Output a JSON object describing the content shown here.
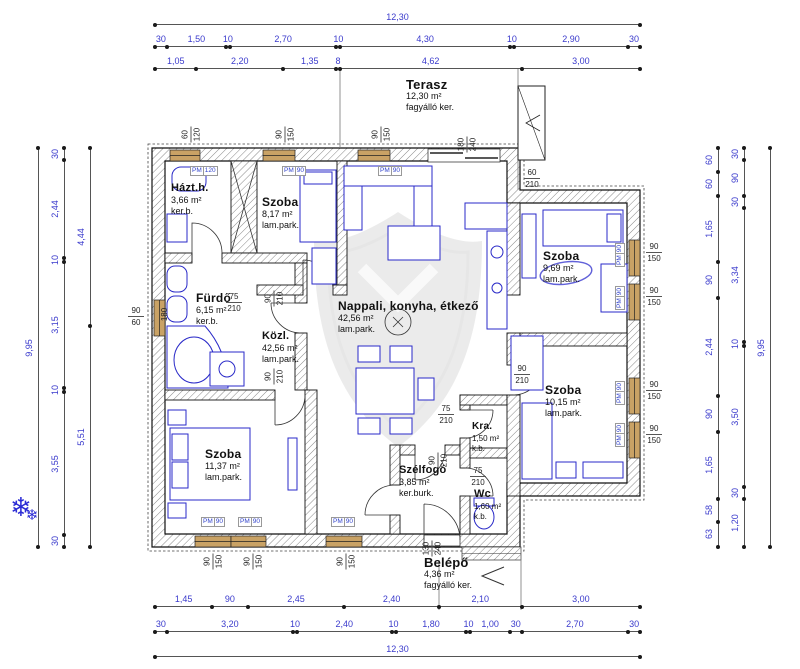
{
  "colors": {
    "dimension": "#3a3acc",
    "wall_outline": "#1a1a1a",
    "furniture": "#2a2ac8",
    "window_frame": "#c9a265",
    "watermark": "#d9d9d9"
  },
  "dims": {
    "top": {
      "total": [
        "12,30"
      ],
      "chain": [
        "30",
        "1,50",
        "10",
        "2,70",
        "10",
        "4,30",
        "10",
        "2,90",
        "30"
      ],
      "chain2": [
        "1,05",
        "2,20",
        "1,35",
        "8",
        "4,62",
        "3,00"
      ]
    },
    "bottom": {
      "chain1": [
        "1,45",
        "90",
        "2,45",
        "2,40",
        "2,10",
        "3,00"
      ],
      "chain2": [
        "30",
        "3,20",
        "10",
        "2,40",
        "10",
        "1,80",
        "10",
        "1,00",
        "30",
        "2,70",
        "30"
      ],
      "total": [
        "12,30"
      ]
    },
    "left": {
      "outer": [
        "9,95"
      ],
      "middle": [
        "30",
        "2,44",
        "10",
        "3,15",
        "10",
        "3,55",
        "30"
      ],
      "inner": [
        "4,44",
        "5,51"
      ]
    },
    "right": {
      "inner": [
        "60",
        "60",
        "1,65",
        "90",
        "2,44",
        "90",
        "1,65",
        "58",
        "63"
      ],
      "middle": [
        "30",
        "90",
        "30",
        "3,34",
        "10",
        "3,50",
        "30",
        "1,20"
      ],
      "outer": [
        "9,95"
      ]
    }
  },
  "rooms": [
    {
      "name": "Terasz",
      "area": "12,30 m²",
      "finish": "fagyálló ker."
    },
    {
      "name": "Házt.h.",
      "area": "3,66 m²",
      "finish": "ker.b."
    },
    {
      "name": "Szoba",
      "area": "8,17 m²",
      "finish": "lam.park."
    },
    {
      "name": "Nappali, konyha, étkező",
      "area": "42,56 m²",
      "finish": "lam.park."
    },
    {
      "name": "Szoba",
      "area": "9,69 m²",
      "finish": "lam.park."
    },
    {
      "name": "Szoba",
      "area": "10,15 m²",
      "finish": "lam.park."
    },
    {
      "name": "Fürdő",
      "area": "6,15 m²",
      "finish": "ker.b."
    },
    {
      "name": "Közl.",
      "area": "42,56 m²",
      "finish": "lam.park."
    },
    {
      "name": "Szoba",
      "area": "11,37 m²",
      "finish": "lam.park."
    },
    {
      "name": "Szélfogó",
      "area": "3,85 m²",
      "finish": "ker.burk."
    },
    {
      "name": "Kra.",
      "area": "1,50 m²",
      "finish": "k.b."
    },
    {
      "name": "Wc",
      "area": "1,60 m²",
      "finish": "k.b."
    },
    {
      "name": "Belépő",
      "area": "4,36 m²",
      "finish": "fagyálló ker."
    }
  ],
  "annotations": [
    {
      "a": "60",
      "b": "120"
    },
    {
      "a": "90",
      "b": "150"
    },
    {
      "a": "90",
      "b": "150"
    },
    {
      "a": "180",
      "b": "240"
    },
    {
      "a": "60",
      "b": "210"
    },
    {
      "a": "90",
      "b": "60"
    },
    {
      "a": "180",
      "b": ""
    },
    {
      "a": "90",
      "b": "150"
    },
    {
      "a": "90",
      "b": "150"
    },
    {
      "a": "90",
      "b": "150"
    },
    {
      "a": "90",
      "b": "150"
    },
    {
      "a": "90",
      "b": "150"
    },
    {
      "a": "90",
      "b": "150"
    },
    {
      "a": "90",
      "b": "150"
    },
    {
      "a": "130",
      "b": "240"
    },
    {
      "a": "75",
      "b": "210"
    },
    {
      "a": "90",
      "b": "210"
    },
    {
      "a": "90",
      "b": "210"
    },
    {
      "a": "75",
      "b": "210"
    },
    {
      "a": "90",
      "b": "210"
    },
    {
      "a": "75",
      "b": "210"
    },
    {
      "a": "90",
      "b": "210"
    }
  ],
  "pm": [
    {
      "a": "PM",
      "b": "120"
    },
    {
      "a": "PM",
      "b": "90"
    },
    {
      "a": "PM",
      "b": "90"
    },
    {
      "a": "PM",
      "b": "90"
    },
    {
      "a": "PM",
      "b": "90"
    },
    {
      "a": "PM",
      "b": "90"
    },
    {
      "a": "PM",
      "b": "90"
    },
    {
      "a": "PM",
      "b": "90"
    },
    {
      "a": "PM",
      "b": "90"
    },
    {
      "a": "PM",
      "b": "90"
    }
  ],
  "symbols": {
    "snowflake": "❄"
  }
}
